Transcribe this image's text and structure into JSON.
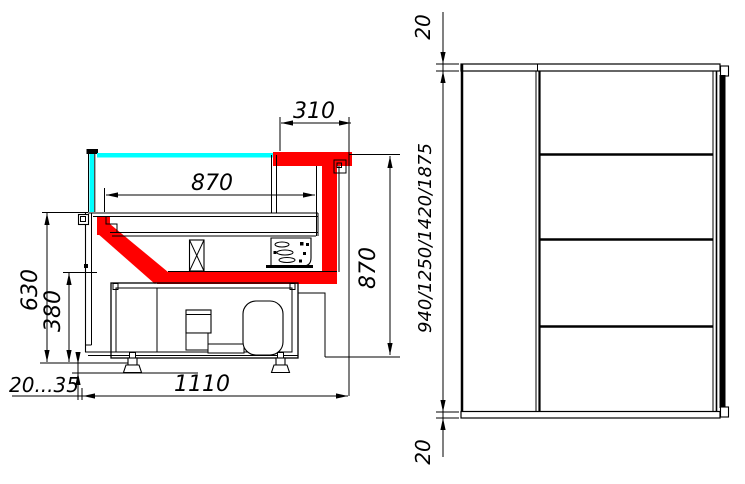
{
  "drawing": {
    "subject": "refrigerated-display-counter-technical-drawing",
    "colors": {
      "accent_red": "#ff0000",
      "glass_cyan": "#00ffff",
      "line": "#000000",
      "background": "#ffffff"
    },
    "section_view": {
      "dimensions": {
        "canopy_depth": "310",
        "display_depth": "870",
        "display_height": "870",
        "front_panel_height": "630",
        "base_section_height": "380",
        "foot_adjustment": "20...35",
        "overall_depth": "1110"
      }
    },
    "elevation_view": {
      "dimensions": {
        "top_clearance": "20",
        "height_options": "940/1250/1420/1875",
        "bottom_clearance": "20"
      }
    }
  }
}
